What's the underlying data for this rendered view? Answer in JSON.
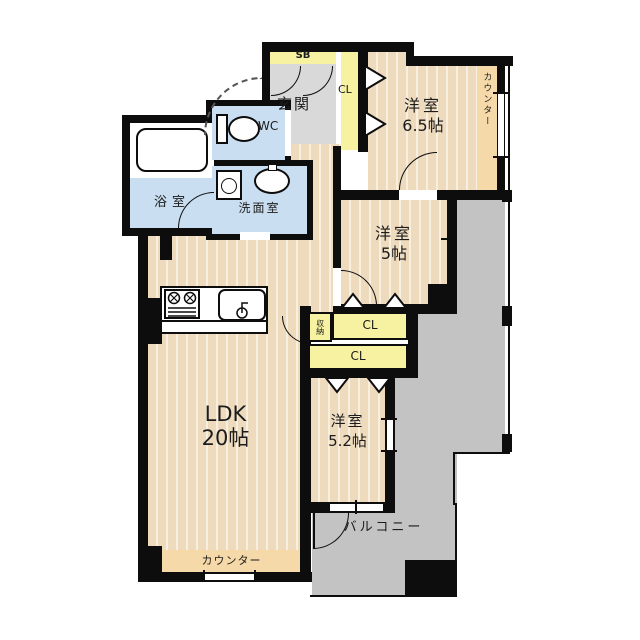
{
  "plan_title": "apartment floor plan",
  "rooms": {
    "shoebox": "SB",
    "entrance": "玄関",
    "hall_closet": "CL",
    "bedroom1": {
      "name": "洋室",
      "size": "6.5帖"
    },
    "counter_right": "カウンター",
    "bath": "浴室",
    "toilet": "WC",
    "washroom": "洗面室",
    "bedroom2": {
      "name": "洋室",
      "size": "5帖"
    },
    "storage": "収納",
    "closet_upper": "CL",
    "closet_lower": "CL",
    "bedroom3": {
      "name": "洋室",
      "size": "5.2帖"
    },
    "ldk": {
      "name": "LDK",
      "size": "20帖"
    },
    "counter_bottom": "カウンター",
    "balcony": "バルコニー"
  },
  "colors": {
    "wall": "#0d0d0d",
    "floor": "#eedabd",
    "floor_stripe": "#f9efde",
    "counter": "#f6d9a8",
    "closet": "#f6f2a1",
    "wet_area": "#c9def1",
    "entrance_floor": "#d9d9d9",
    "outdoor": "#c3c3c3"
  }
}
